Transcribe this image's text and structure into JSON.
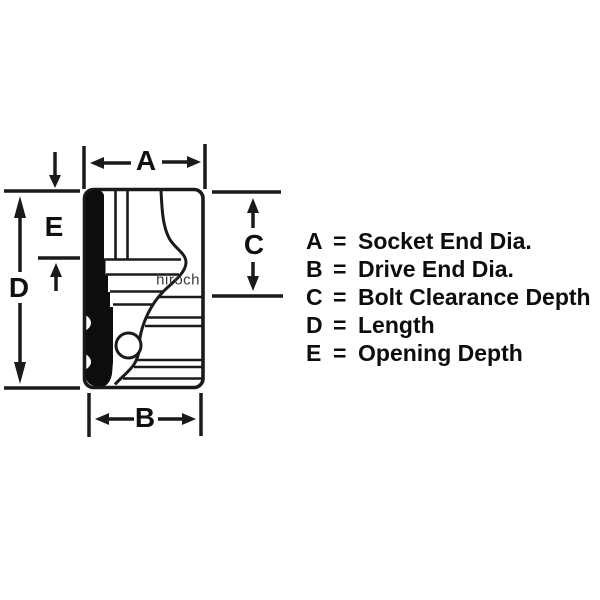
{
  "page": {
    "background_color": "#ffffff",
    "line_color": "#1a1a1a",
    "solid_fill_color": "#0d0d0d"
  },
  "diagram": {
    "labels": {
      "a": "A",
      "b": "B",
      "c": "C",
      "d": "D",
      "e": "E"
    }
  },
  "watermark": {
    "text": "hirochi",
    "color": "#3a3a3a"
  },
  "legend": {
    "eq": "=",
    "items": [
      {
        "letter": "A",
        "desc": "Socket End Dia."
      },
      {
        "letter": "B",
        "desc": "Drive End Dia."
      },
      {
        "letter": "C",
        "desc": "Bolt Clearance Depth"
      },
      {
        "letter": "D",
        "desc": "Length"
      },
      {
        "letter": "E",
        "desc": "Opening Depth"
      }
    ]
  }
}
